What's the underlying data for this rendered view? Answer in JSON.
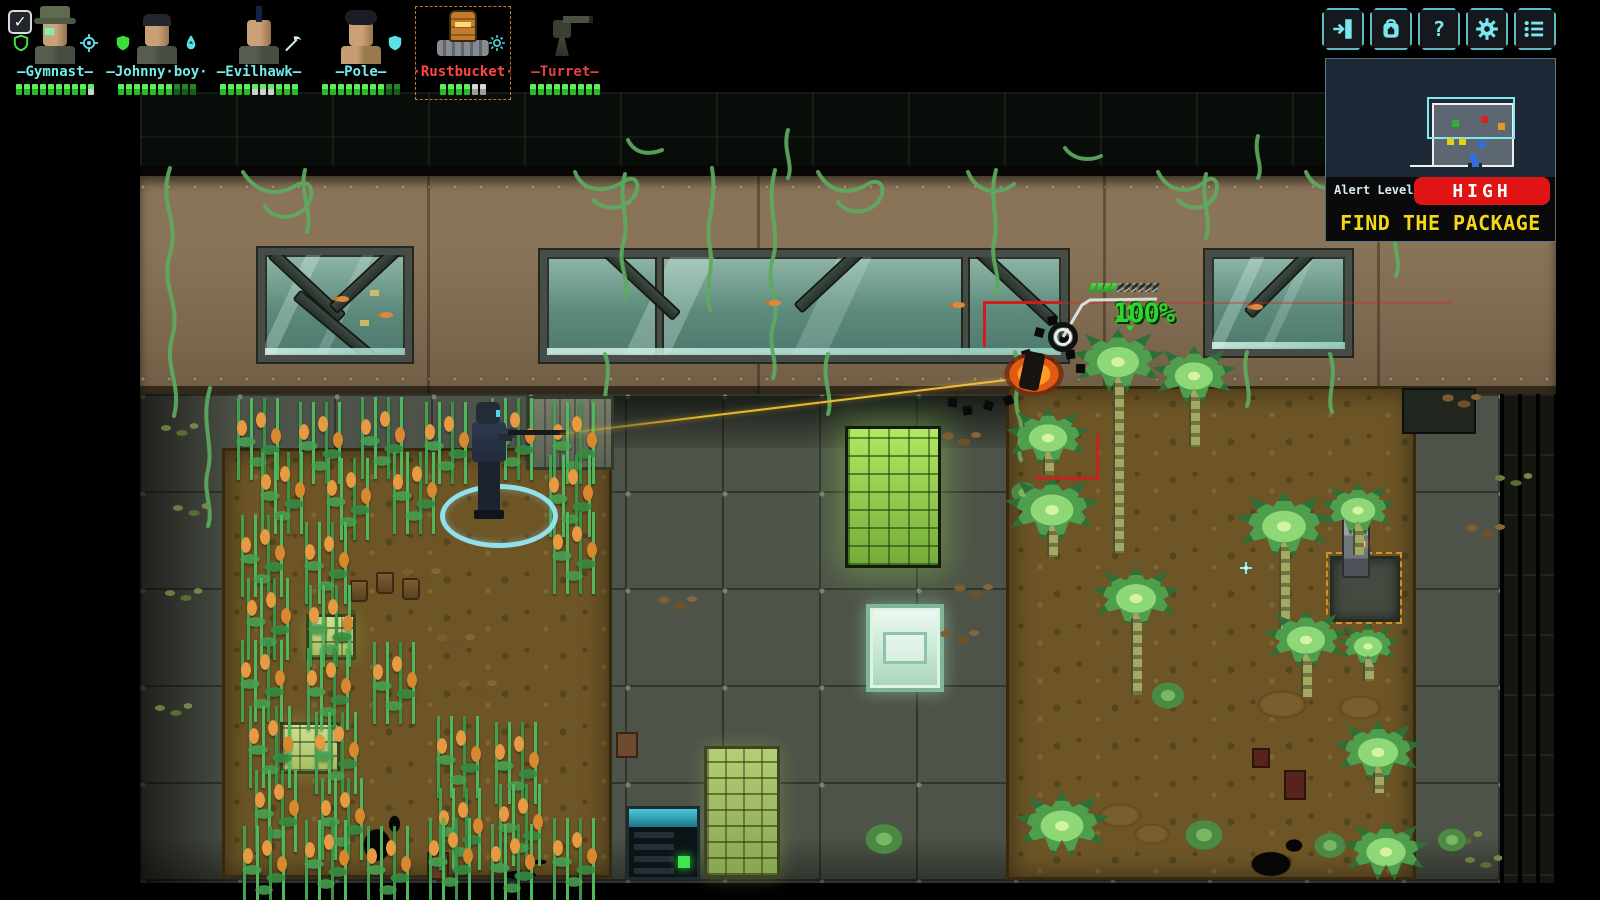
{
  "hud": {
    "checkbox": {
      "glyph": "✓",
      "checked": true
    },
    "squad": [
      {
        "id": "gymnast",
        "name": "—Gymnast—",
        "color": "#74ecec",
        "portrait": "gymnast",
        "left_icon": "shield-outline-icon",
        "right_icon": "crosshair-icon",
        "selected": false,
        "hp": [
          "full",
          "full",
          "full",
          "full",
          "full",
          "full",
          "full",
          "full",
          "full",
          "half"
        ]
      },
      {
        "id": "johnnyboy",
        "name": "—Johnny·boy·",
        "color": "#74ecec",
        "portrait": "johnnyboy",
        "left_icon": "shield-green-icon",
        "right_icon": "droplet-icon",
        "selected": false,
        "hp": [
          "full",
          "full",
          "full",
          "full",
          "full",
          "full",
          "full",
          "dim",
          "dim",
          "dim"
        ]
      },
      {
        "id": "evilhawk",
        "name": "—Evilhawk—",
        "color": "#74ecec",
        "portrait": "evilhawk",
        "left_icon": null,
        "right_icon": "pickaxe-icon",
        "selected": false,
        "hp": [
          "full",
          "full",
          "full",
          "full",
          "half",
          "half",
          "half",
          "full",
          "full",
          "full"
        ]
      },
      {
        "id": "pole",
        "name": "—Pole—",
        "color": "#74ecec",
        "portrait": "pole",
        "left_icon": null,
        "right_icon": "shield-cyan-icon",
        "selected": false,
        "hp": [
          "full",
          "full",
          "full",
          "full",
          "full",
          "full",
          "full",
          "full",
          "dim",
          "dim"
        ]
      },
      {
        "id": "rustbucket",
        "name": "·Rustbucket·",
        "color": "#ff4545",
        "portrait": "rustbucket",
        "left_icon": null,
        "right_icon": "gear-burst-icon",
        "selected": true,
        "hp": [
          "full",
          "full",
          "full",
          "full",
          "grey",
          "grey"
        ]
      },
      {
        "id": "turret",
        "name": "—Turret—",
        "color": "#e84040",
        "portrait": "turret",
        "left_icon": null,
        "right_icon": null,
        "selected": false,
        "hp": [
          "full",
          "full",
          "full",
          "full",
          "full",
          "full",
          "full",
          "full",
          "full"
        ]
      }
    ],
    "top_buttons": [
      {
        "name": "exit-button",
        "icon": "door-exit-icon"
      },
      {
        "name": "inventory-button",
        "icon": "backpack-icon"
      },
      {
        "name": "help-button",
        "icon": "question-icon"
      },
      {
        "name": "settings-button",
        "icon": "gear-icon"
      },
      {
        "name": "menu-button",
        "icon": "list-icon"
      }
    ],
    "status_panel": {
      "alert_label": "Alert Level",
      "alert_value": "HIGH",
      "alert_color": "#e01414",
      "objective": "FIND THE PACKAGE",
      "objective_color": "#f2d71a",
      "minimap": {
        "dots": [
          {
            "x": 126,
            "y": 61,
            "c": "#2db42d"
          },
          {
            "x": 155,
            "y": 57,
            "c": "#d42424"
          },
          {
            "x": 172,
            "y": 64,
            "c": "#e09a20"
          },
          {
            "x": 121,
            "y": 79,
            "c": "#e0cf20"
          },
          {
            "x": 133,
            "y": 79,
            "c": "#e0cf20"
          },
          {
            "x": 152,
            "y": 82,
            "c": "#2f6fe0"
          },
          {
            "x": 144,
            "y": 95,
            "c": "#2f6fe0"
          },
          {
            "x": 146,
            "y": 101,
            "c": "#2f6fe0"
          }
        ]
      }
    },
    "target_info": {
      "hit_chance": "100%",
      "hp": [
        "full",
        "full",
        "full",
        "full",
        "empty",
        "empty",
        "empty",
        "empty",
        "empty",
        "empty"
      ]
    }
  },
  "scene": {
    "corn": [
      [
        228,
        398
      ],
      [
        290,
        402
      ],
      [
        352,
        397
      ],
      [
        416,
        402
      ],
      [
        482,
        398
      ],
      [
        544,
        402
      ],
      [
        252,
        452
      ],
      [
        318,
        458
      ],
      [
        384,
        452
      ],
      [
        540,
        455
      ],
      [
        232,
        515
      ],
      [
        296,
        522
      ],
      [
        544,
        512
      ],
      [
        238,
        578
      ],
      [
        300,
        585
      ],
      [
        232,
        640
      ],
      [
        298,
        648
      ],
      [
        364,
        642
      ],
      [
        240,
        706
      ],
      [
        306,
        712
      ],
      [
        428,
        716
      ],
      [
        486,
        722
      ],
      [
        246,
        770
      ],
      [
        312,
        778
      ],
      [
        430,
        788
      ],
      [
        490,
        784
      ],
      [
        234,
        826
      ],
      [
        296,
        820
      ],
      [
        358,
        826
      ],
      [
        420,
        818
      ],
      [
        482,
        824
      ],
      [
        544,
        818
      ]
    ],
    "palms": [
      [
        1048,
        438,
        84,
        36
      ],
      [
        1118,
        362,
        92,
        190
      ],
      [
        1194,
        376,
        84,
        70
      ],
      [
        1052,
        510,
        94,
        46
      ],
      [
        1136,
        598,
        88,
        96
      ],
      [
        1284,
        526,
        96,
        108
      ],
      [
        1358,
        510,
        76,
        44
      ],
      [
        1306,
        640,
        84,
        56
      ],
      [
        1368,
        646,
        62,
        34
      ],
      [
        1062,
        826,
        94,
        0
      ],
      [
        1378,
        752,
        88,
        40
      ],
      [
        1386,
        852,
        86,
        0
      ]
    ],
    "shrubs": [
      [
        1168,
        700,
        46
      ],
      [
        1204,
        840,
        52
      ],
      [
        1330,
        850,
        44
      ],
      [
        884,
        844,
        52
      ],
      [
        1452,
        844,
        40
      ],
      [
        1024,
        496,
        36
      ]
    ],
    "mounds": [
      [
        1282,
        702,
        70
      ],
      [
        1360,
        706,
        60
      ],
      [
        1152,
        832,
        50
      ],
      [
        1120,
        814,
        60
      ]
    ],
    "props": [
      [
        "server",
        845,
        426,
        96,
        142
      ],
      [
        "glass",
        866,
        604,
        78,
        88
      ],
      [
        "pallet",
        704,
        746,
        76,
        132
      ],
      [
        "greenbox",
        306,
        614,
        50,
        46
      ],
      [
        "greenbox",
        280,
        722,
        60,
        52
      ],
      [
        "elevator",
        626,
        806,
        74,
        74
      ],
      [
        "btn",
        678,
        856,
        12,
        12
      ],
      [
        "locker",
        526,
        396,
        88,
        74
      ],
      [
        "darkcab",
        1402,
        388,
        74,
        46
      ],
      [
        "inset",
        1330,
        556,
        70,
        66
      ],
      [
        "bracket",
        1326,
        552,
        76,
        72
      ],
      [
        "robot",
        1342,
        516,
        28,
        62
      ],
      [
        "crate",
        616,
        732,
        22,
        26
      ],
      [
        "crate2",
        427,
        852,
        22,
        28
      ],
      [
        "crate3",
        1284,
        770,
        22,
        30
      ],
      [
        "crate3",
        1252,
        748,
        18,
        20
      ],
      [
        "pot",
        350,
        580,
        18,
        22
      ],
      [
        "pot",
        376,
        572,
        18,
        22
      ],
      [
        "pot",
        402,
        578,
        18,
        22
      ],
      [
        "sparkle",
        1240,
        562,
        12,
        12
      ]
    ],
    "splats": [
      [
        356,
        820,
        42,
        50
      ],
      [
        1240,
        845,
        62,
        38
      ],
      [
        495,
        868,
        50,
        14
      ]
    ],
    "debris_brown": [
      [
        396,
        564
      ],
      [
        430,
        630
      ],
      [
        452,
        676
      ],
      [
        936,
        428
      ],
      [
        948,
        580
      ],
      [
        934,
        626
      ],
      [
        1436,
        390
      ],
      [
        1460,
        520
      ],
      [
        652,
        592
      ]
    ],
    "debris_green": [
      [
        156,
        420
      ],
      [
        168,
        500
      ],
      [
        160,
        585
      ],
      [
        150,
        700
      ],
      [
        1490,
        470
      ],
      [
        1440,
        828
      ],
      [
        1460,
        852
      ]
    ],
    "smoke": [
      [
        1035,
        328
      ],
      [
        1048,
        316
      ],
      [
        1060,
        336
      ],
      [
        1022,
        350
      ],
      [
        1044,
        358
      ],
      [
        1066,
        350
      ],
      [
        948,
        398
      ],
      [
        963,
        406
      ],
      [
        984,
        401
      ],
      [
        1004,
        396
      ],
      [
        1076,
        364
      ]
    ],
    "fish": [
      [
        336,
        296
      ],
      [
        380,
        312
      ],
      [
        768,
        300
      ],
      [
        952,
        302
      ],
      [
        1250,
        304
      ]
    ],
    "tags": [
      [
        370,
        290
      ],
      [
        360,
        320
      ]
    ]
  }
}
